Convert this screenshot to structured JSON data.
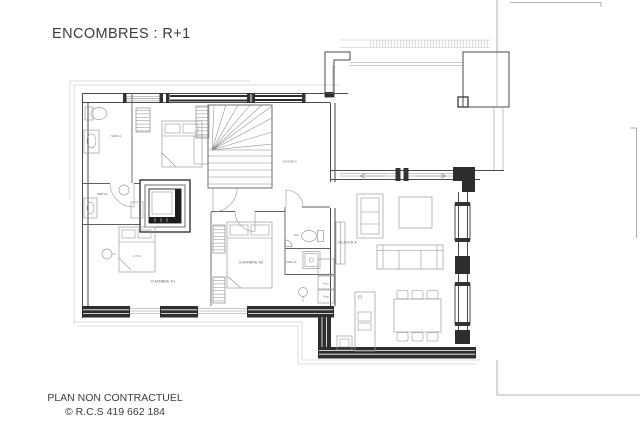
{
  "page": {
    "title": "ENCOMBRES : R+1",
    "footer_line1": "PLAN NON CONTRACTUEL",
    "footer_line2": "© R.C.S 419 662 184"
  },
  "plan": {
    "labels": {
      "sdb_a1": "SDB A1",
      "sdb_a2": "SDB A2",
      "chambre_a1": "CHAMBRE A1",
      "chambre_a2": "CHAMBRE A2",
      "lit": "LIT A1",
      "wc": "WC",
      "sde_a2": "SDE A2",
      "sejour": "SEJOUR A",
      "cuisine": "CUISINE A",
      "four": "Four",
      "frigo": "Frigo"
    }
  }
}
